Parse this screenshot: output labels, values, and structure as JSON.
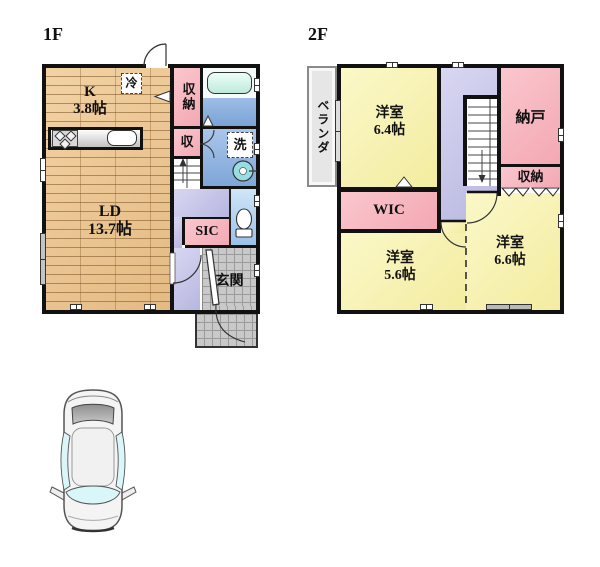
{
  "floors": {
    "f1": {
      "title": "1F",
      "rooms": {
        "kitchen": {
          "name": "K",
          "size": "3.8帖"
        },
        "living": {
          "name": "LD",
          "size": "13.7帖"
        },
        "storage": {
          "name": "収納"
        },
        "closet": {
          "name": "収"
        },
        "sic": {
          "name": "SIC"
        },
        "entrance": {
          "name": "玄関"
        }
      },
      "fixtures": {
        "fridge": "冷",
        "laundry": "洗"
      }
    },
    "f2": {
      "title": "2F",
      "rooms": {
        "veranda": {
          "name": "ベランダ"
        },
        "bedroom_64": {
          "name": "洋室",
          "size": "6.4帖"
        },
        "storeroom": {
          "name": "納戸"
        },
        "closet": {
          "name": "収納"
        },
        "wic": {
          "name": "WIC"
        },
        "bedroom_56": {
          "name": "洋室",
          "size": "5.6帖"
        },
        "bedroom_66": {
          "name": "洋室",
          "size": "6.6帖"
        }
      }
    }
  },
  "palette": {
    "wall": "#111111",
    "wood_floor": "#ebc795",
    "room_pink": "#f8bcc4",
    "room_yellow": "#faf6b8",
    "hallway_lavender": "#c9c8e9",
    "washroom_blue": "#8fb4e2",
    "toilet_blue": "#b6d7f0",
    "bath_blue": "#85abdc",
    "bathtub_mint": "#d7f5ea",
    "tile_grey": "#c9c9c9",
    "veranda_grey": "#e5e5e5",
    "fixture_cyan": "#8fd9de",
    "car_body": "#f4f4f4",
    "car_glass": "#d9f6f8"
  }
}
